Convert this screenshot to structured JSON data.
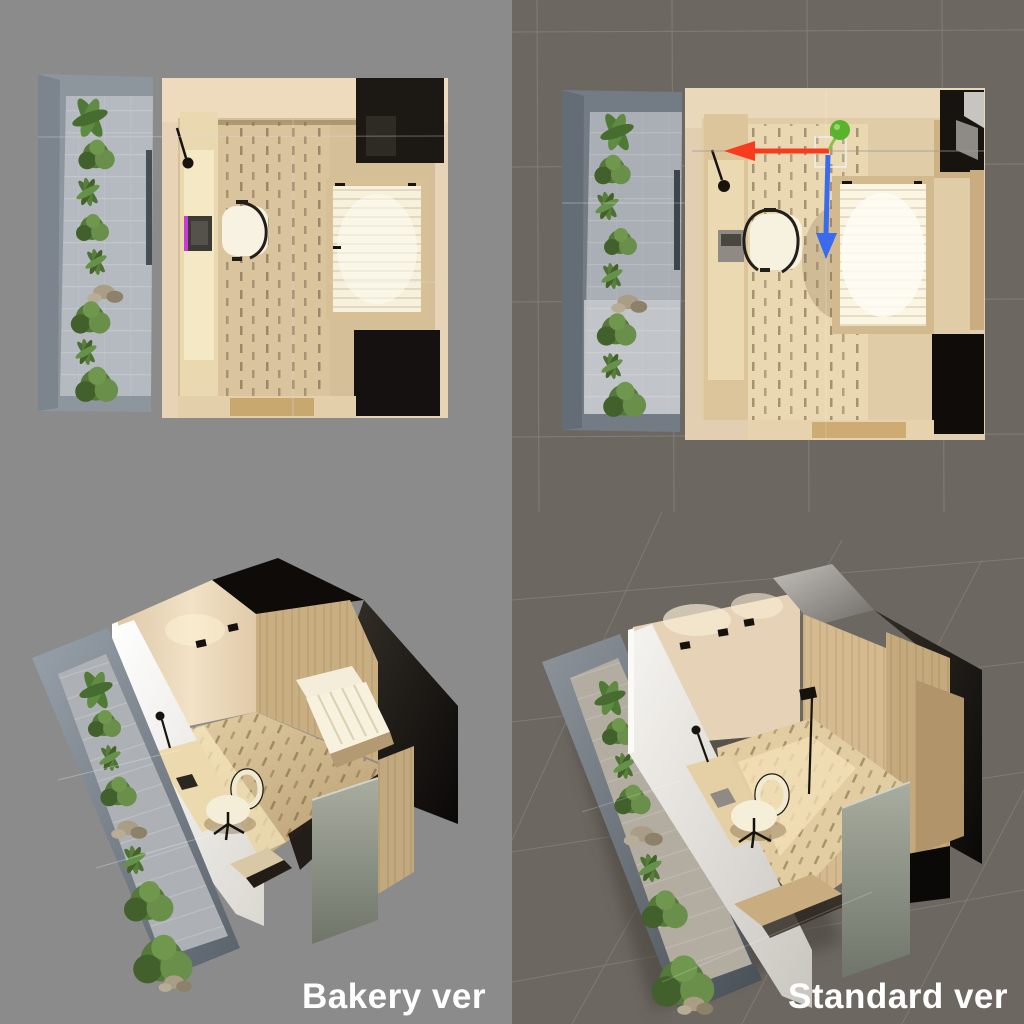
{
  "captions": {
    "bakery": "Bakery ver",
    "standard": "Standard ver"
  },
  "palette": {
    "left_background": "#8b8b8b",
    "right_background": "#6d6761",
    "viewport_grid_line": "#958e86",
    "caption_color": "#ffffff",
    "wall_cream": "#e7d3b5",
    "floor_wood": "#d5bf99",
    "floor_wood_lit": "#f4e6bd",
    "desk_wood": "#e9d8b0",
    "concrete_wall": "#8d959d",
    "courtyard_floor": "#b4bac0",
    "plant_green": "#5b7e3d",
    "rock_beige": "#a99d86",
    "bed_mattress": "#f7f0dd",
    "bed_frame_wood": "#d7c096",
    "wardrobe_black": "#1c1813",
    "chair_cream": "#f8f2e2",
    "chair_trim_black": "#221e19",
    "laptop_dark": "#3c3a35",
    "laptop_accent_magenta": "#c83bd6",
    "white_wall": "#ffffff",
    "gizmo_x_axis": "#f93b1d",
    "gizmo_y_axis": "#59b42c",
    "gizmo_z_axis": "#3a6bed",
    "gizmo_plane_handle": "#eeeeee"
  }
}
